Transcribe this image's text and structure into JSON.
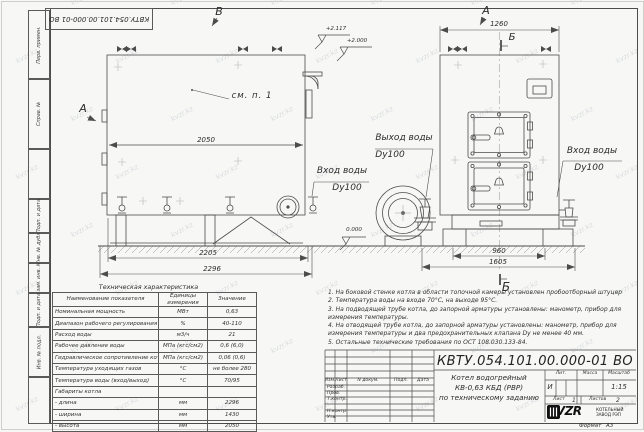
{
  "sheet": {
    "doc_number": "КВТУ.054.101.00.000-01 ВО",
    "format_label": "Формат",
    "format_value": "А3"
  },
  "watermark": {
    "text": "kvzr.kz"
  },
  "margin_column": {
    "cells": [
      {
        "label": "Перв. примен."
      },
      {
        "label": "Справ. №"
      },
      {
        "label": ""
      },
      {
        "label": "Подп. и дата"
      },
      {
        "label": "Инв. № дубл."
      },
      {
        "label": "Взам. инв. №"
      },
      {
        "label": "Подп. и дата"
      },
      {
        "label": "Инв. № подл."
      },
      {
        "label": ""
      }
    ]
  },
  "drawing": {
    "view_marks": {
      "top_view_b": "В",
      "side_arrow_a": "А",
      "front_view_a": "А",
      "section_b_top": "Б",
      "section_b_bottom": "Б"
    },
    "annotations": {
      "see_item": "см. п. 1"
    },
    "elevations": {
      "top1": "+2.117",
      "top2": "+2.000",
      "ground": "0.000"
    },
    "dimensions": {
      "body_length": "2050",
      "base_length": "2205",
      "overall_length": "2296",
      "front_width": "1260",
      "base_width": "960",
      "overall_width": "1605"
    },
    "port_labels": {
      "outlet_line1": "Выход воды",
      "outlet_line2": "Dy100",
      "inlet_left_line1": "Вход воды",
      "inlet_left_line2": "Dy100",
      "inlet_right_line1": "Вход воды",
      "inlet_right_line2": "Dy100"
    }
  },
  "spec_table": {
    "title": "Техническая характеристика",
    "col_param": "Наименование показателя",
    "col_units": "Единицы измерения",
    "col_value": "Значение",
    "rows": [
      {
        "param": "Номинальная мощность",
        "units": "МВт",
        "value": "0,63"
      },
      {
        "param": "Диапазон рабочего регулирования",
        "units": "%",
        "value": "40-110"
      },
      {
        "param": "Расход воды",
        "units": "м3/ч",
        "value": "21"
      },
      {
        "param": "Рабочее давление воды",
        "units": "МПа (кгс/см2)",
        "value": "0,6 (6,0)"
      },
      {
        "param": "Гидравлическое сопротивление котла",
        "units": "МПа (кгс/см2)",
        "value": "0,06 (0,6)"
      },
      {
        "param": "Температура уходящих газов",
        "units": "°С",
        "value": "не более 280"
      },
      {
        "param": "Температура воды (вход/выход)",
        "units": "°С",
        "value": "70/95"
      },
      {
        "param": "Габариты котла",
        "units": "",
        "value": ""
      },
      {
        "param": "- длина",
        "units": "мм",
        "value": "2296"
      },
      {
        "param": "- ширина",
        "units": "мм",
        "value": "1430"
      },
      {
        "param": "- высота",
        "units": "мм",
        "value": "2050"
      }
    ]
  },
  "notes": [
    "1. На боковой стенке котла в области топочной камеры установлен пробоотборный штуцер",
    "2. Температура воды на входе 70°С, на выходе 95°С.",
    "3. На подводящей трубе котла, до запорной арматуры установлены: манометр, прибор для измерения температуры.",
    "4. На отводящей трубе котла, до запорной арматуры установлены: манометр, прибор для измерения температуры и два предохранительных клапана Dу не менее 40 мм.",
    "5. Остальные технические требования по ОСТ 108.030.133-84."
  ],
  "title_block": {
    "cols": {
      "izm": "Изм.",
      "list": "Лист",
      "doc": "N докум.",
      "sign": "Подп.",
      "date": "Дата"
    },
    "signature_rows": [
      "Разраб.",
      "Пров.",
      "Т.контр.",
      "",
      "Н.контр.",
      "Утв."
    ],
    "product_line1": "Котел водогрейный",
    "product_line2": "КВ-0,63 КБД (РВР)",
    "product_line3": "по техническому заданию",
    "lit_label": "Лит.",
    "lit_value": "И",
    "mass_label": "Масса",
    "scale_label": "Масштаб",
    "scale_value": "1:15",
    "sheet_label": "Лист",
    "sheet_value": "1",
    "sheets_label": "Листов",
    "sheets_value": "2",
    "logo_text": "KVZR",
    "company_line1": "КОТЕЛЬНЫЙ",
    "company_line2": "ЗАВОД РЭП"
  }
}
